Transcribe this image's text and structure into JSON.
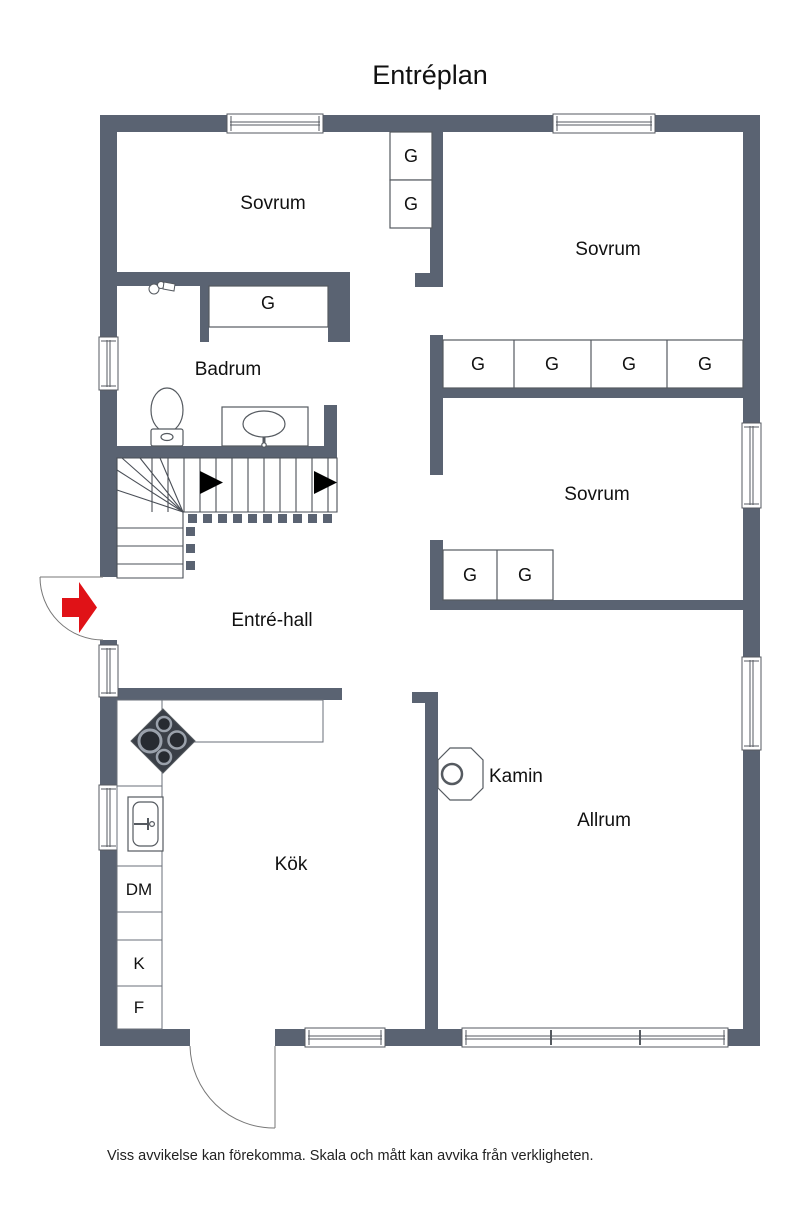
{
  "title": "Entréplan",
  "footer": "Viss avvikelse kan förekomma. Skala och mått kan avvika från verkligheten.",
  "labels": {
    "bedroom": "Sovrum",
    "bathroom": "Badrum",
    "hall": "Entré-hall",
    "kitchen": "Kök",
    "living_room": "Allrum",
    "fireplace": "Kamin",
    "wardrobe": "G",
    "dishwasher": "DM",
    "fridge": "K",
    "freezer": "F"
  },
  "colors": {
    "wall": "#5a6372",
    "fixture_line": "#555a60",
    "entry_arrow_red": "#e01217",
    "stove_dark": "#3a3f47",
    "text": "#111111"
  }
}
